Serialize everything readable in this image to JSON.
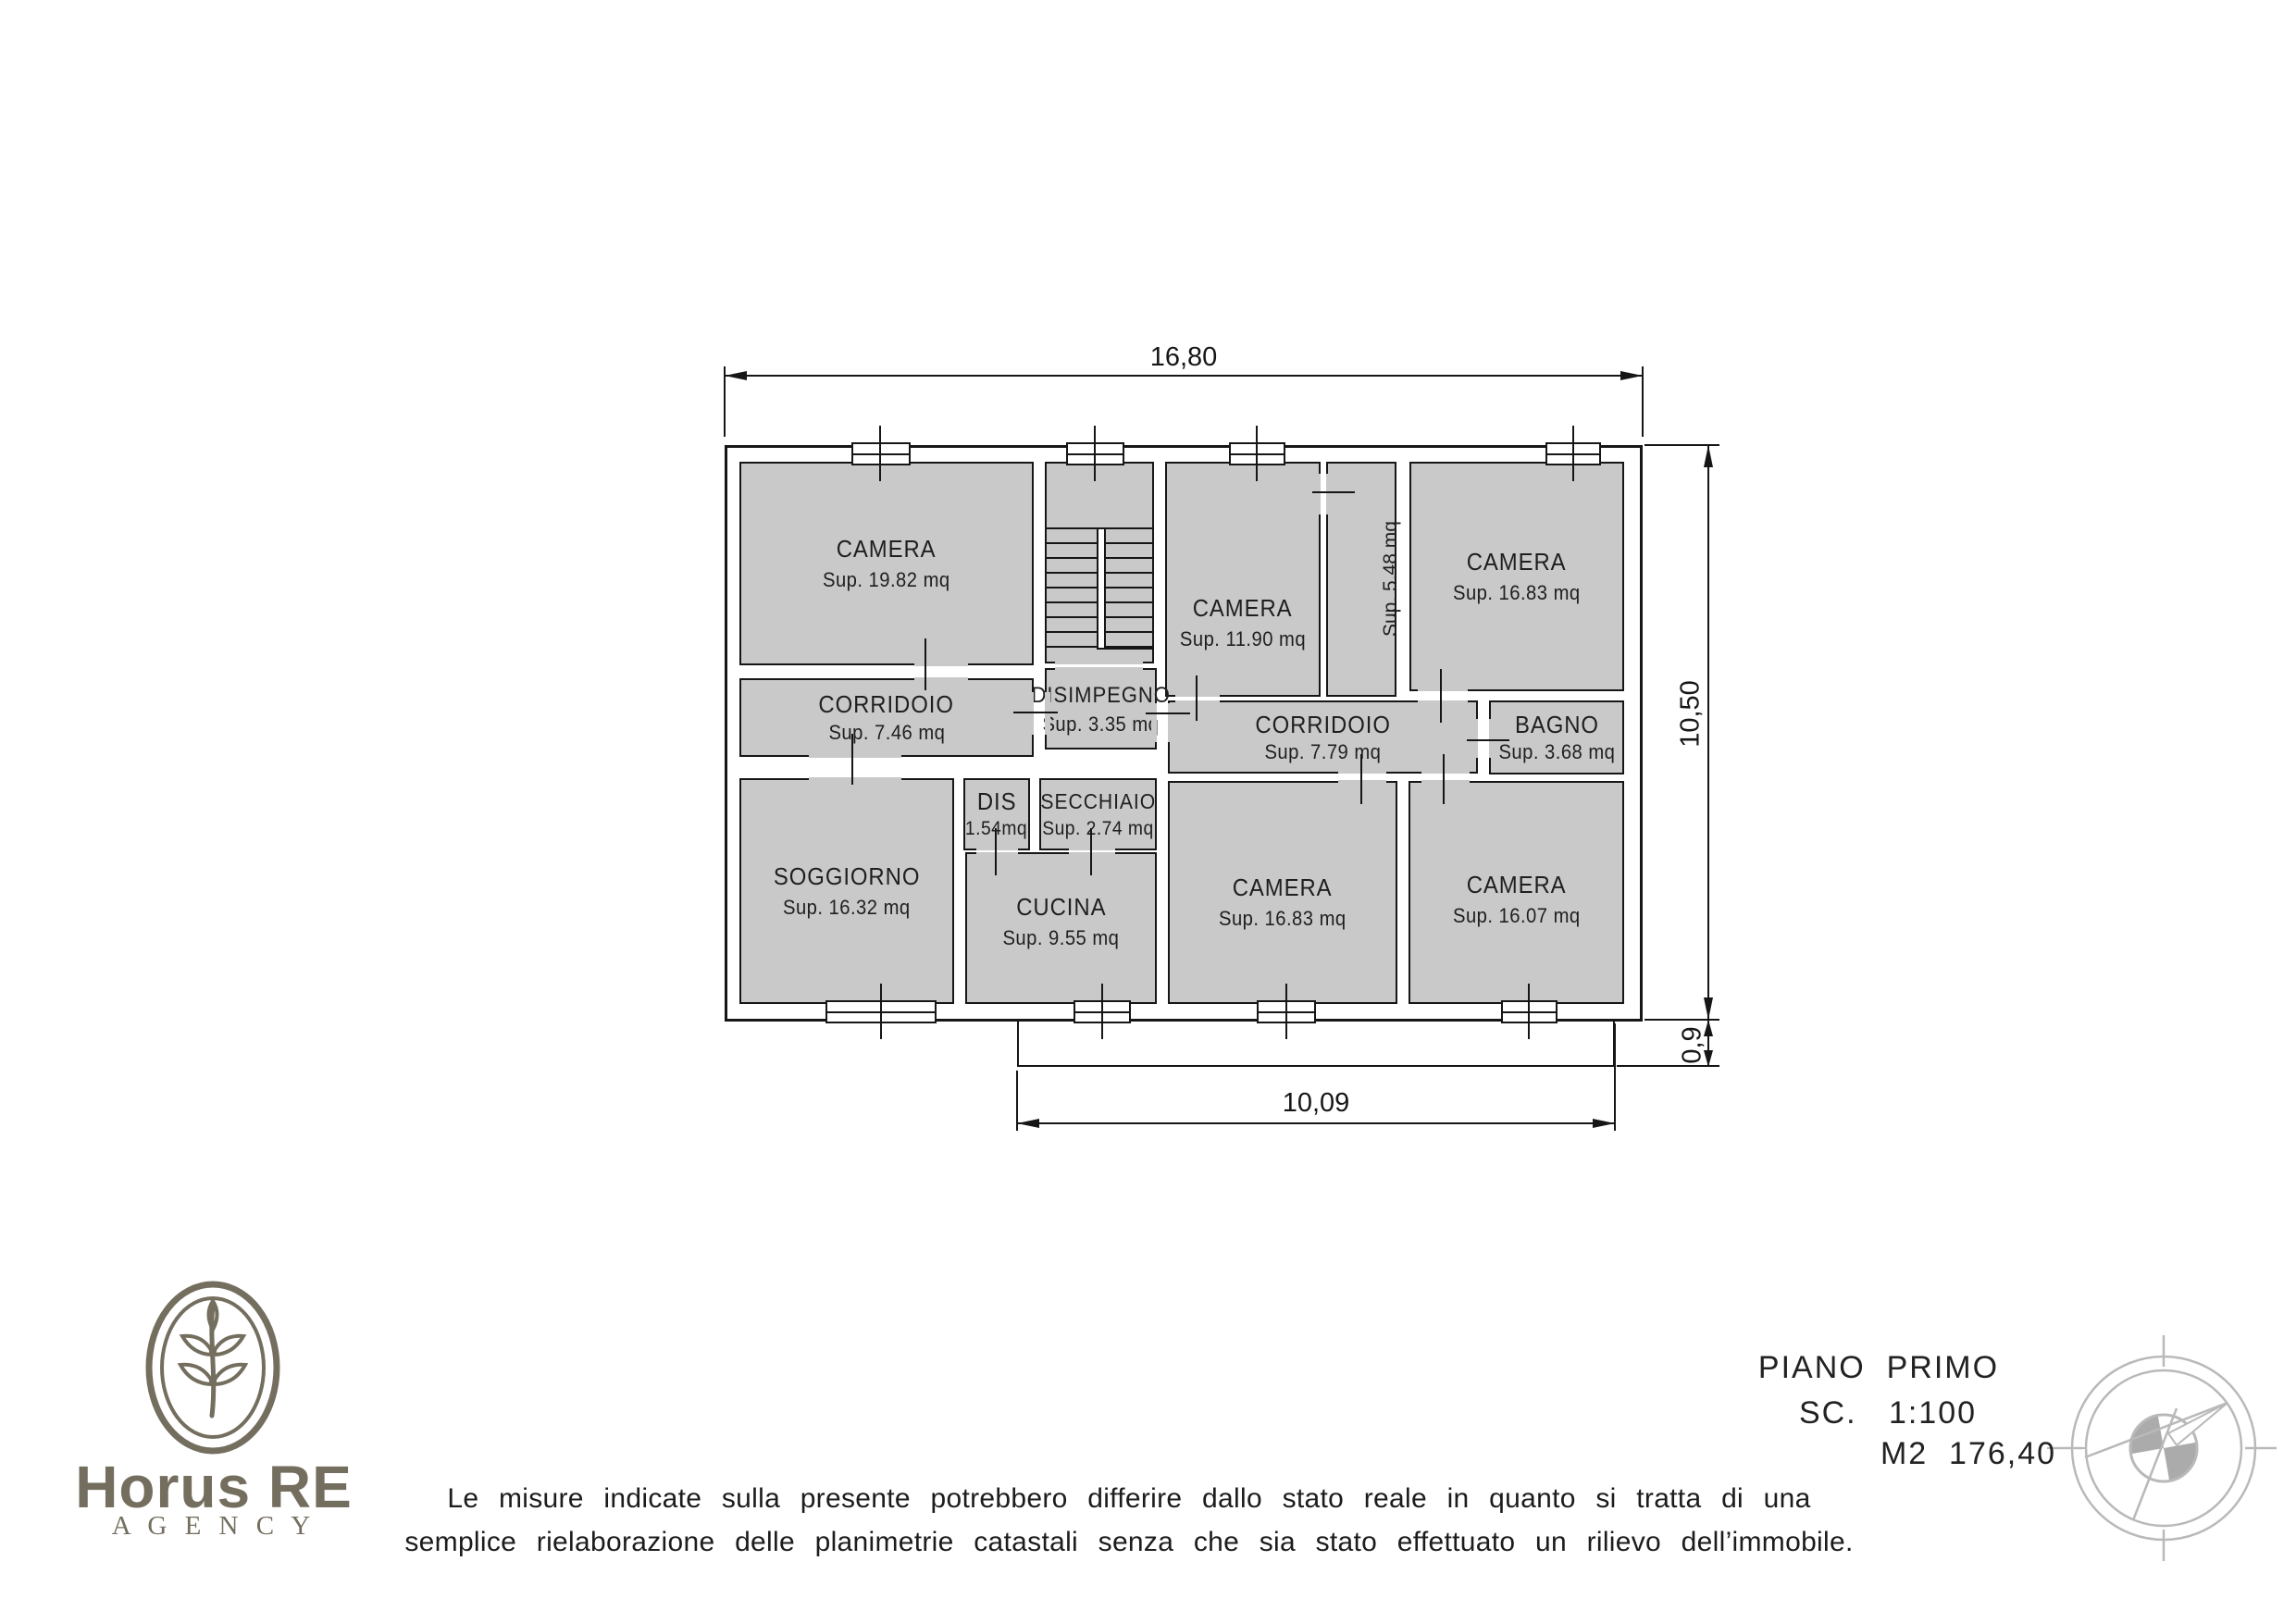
{
  "colors": {
    "room_fill": "#c9c9c9",
    "line": "#161616",
    "logo": "#746e5f",
    "compass": "#b9b9b9"
  },
  "plan": {
    "dimensions": {
      "top": "16,80",
      "right": "10,50",
      "bottom": "10,09",
      "balcony": "0,9"
    },
    "rooms": [
      {
        "name": "CAMERA",
        "area": "Sup. 19.82 mq"
      },
      {
        "name": "CAMERA",
        "area": "Sup. 11.90 mq"
      },
      {
        "name": "BAGNO",
        "area": "Sup. 5.48 mq"
      },
      {
        "name": "CAMERA",
        "area": "Sup. 16.83 mq"
      },
      {
        "name": "CORRIDOIO",
        "area": "Sup. 7.46 mq"
      },
      {
        "name": "DISIMPEGNO",
        "area": "Sup. 3.35 mq"
      },
      {
        "name": "CORRIDOIO",
        "area": "Sup. 7.79 mq"
      },
      {
        "name": "BAGNO",
        "area": "Sup. 3.68 mq"
      },
      {
        "name": "DIS",
        "area": "1.54mq"
      },
      {
        "name": "SECCHIAIO",
        "area": "Sup. 2.74 mq"
      },
      {
        "name": "SOGGIORNO",
        "area": "Sup. 16.32 mq"
      },
      {
        "name": "CUCINA",
        "area": "Sup. 9.55 mq"
      },
      {
        "name": "CAMERA",
        "area": "Sup. 16.83 mq"
      },
      {
        "name": "CAMERA",
        "area": "Sup. 16.07 mq"
      }
    ]
  },
  "title_block": {
    "floor": "PIANO  PRIMO",
    "scale": "SC.   1:100",
    "total_area": "M2  176,40"
  },
  "logo": {
    "brand": "Horus RE",
    "agency": "A G E N C Y"
  },
  "disclaimer": {
    "line1": "Le misure indicate sulla presente potrebbero differire dallo stato reale in quanto si tratta di una",
    "line2": "semplice rielaborazione delle planimetrie catastali senza che sia stato effettuato un rilievo dell’immobile."
  }
}
